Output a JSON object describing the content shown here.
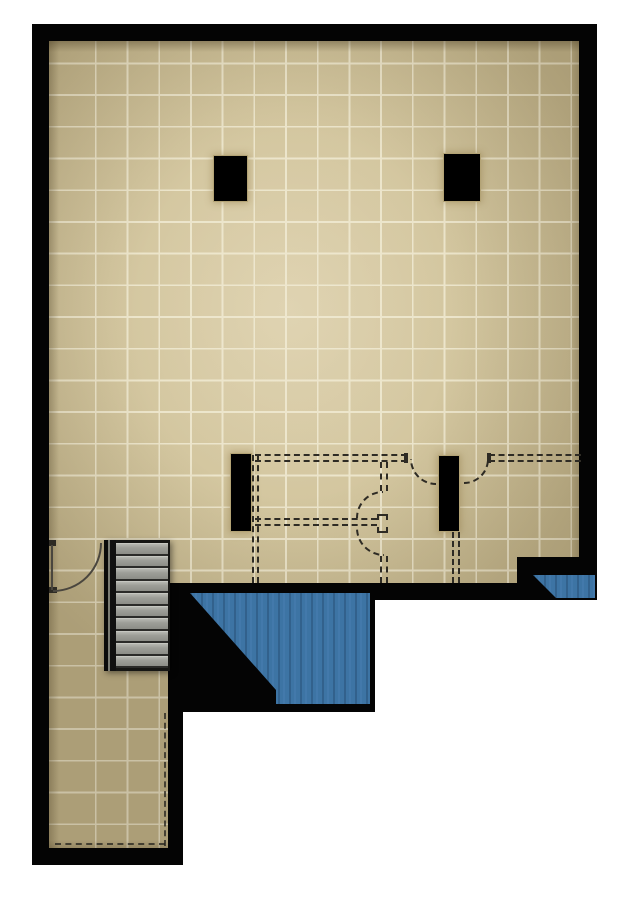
{
  "meta": {
    "type": "architectural-floor-plan-render",
    "canvas_width": 630,
    "canvas_height": 900
  },
  "palette": {
    "wall": "#040404",
    "floor": "#d3c69f",
    "floor_light": "#dccfab",
    "floor_dark": "#c5b890",
    "grid_line": "#ece5cb",
    "column_outline": "#b3a375",
    "stair_frame": "#161614",
    "stair_tread_edge": "#2b2b29",
    "water_base": "#3d74a4",
    "water_dark": "#32618c",
    "water_light": "#4379ab",
    "dashed_line": "#2e2b24",
    "door_arc": "#4a463e"
  },
  "grid": {
    "tile_size": 31.7,
    "offset_x": 16,
    "offset_y": 7
  },
  "floor": {
    "polygon": [
      [
        49,
        41
      ],
      [
        579,
        41
      ],
      [
        579,
        557
      ],
      [
        517,
        557
      ],
      [
        517,
        583
      ],
      [
        168,
        583
      ],
      [
        168,
        848
      ],
      [
        49,
        848
      ]
    ]
  },
  "walls": [
    {
      "name": "wall-top",
      "x": 32,
      "y": 24,
      "w": 565,
      "h": 17
    },
    {
      "name": "wall-left",
      "x": 32,
      "y": 24,
      "w": 17,
      "h": 841
    },
    {
      "name": "wall-right",
      "x": 579,
      "y": 24,
      "w": 18,
      "h": 576
    },
    {
      "name": "wall-main-bottom",
      "x": 183,
      "y": 583,
      "w": 414,
      "h": 17
    },
    {
      "name": "wall-bottom-notch",
      "x": 517,
      "y": 557,
      "w": 80,
      "h": 26
    },
    {
      "name": "wall-corridor-right",
      "x": 168,
      "y": 582,
      "w": 15,
      "h": 283
    },
    {
      "name": "wall-corridor-bottom",
      "x": 32,
      "y": 848,
      "w": 151,
      "h": 17
    },
    {
      "name": "void-below-floor",
      "x": 183,
      "y": 583,
      "w": 192,
      "h": 129
    }
  ],
  "water": [
    {
      "name": "pool-lower-left",
      "polygon": [
        [
          190,
          593
        ],
        [
          370,
          593
        ],
        [
          370,
          704
        ],
        [
          276,
          704
        ],
        [
          276,
          690
        ]
      ]
    },
    {
      "name": "pool-lower-right",
      "polygon": [
        [
          533,
          575
        ],
        [
          595,
          575
        ],
        [
          595,
          598
        ],
        [
          556,
          598
        ]
      ]
    }
  ],
  "columns": [
    {
      "name": "column-upper-left",
      "x": 213,
      "y": 155,
      "w": 35,
      "h": 47
    },
    {
      "name": "column-upper-right",
      "x": 443,
      "y": 153,
      "w": 38,
      "h": 49
    },
    {
      "name": "column-lower-left",
      "x": 230,
      "y": 453,
      "w": 22,
      "h": 79
    },
    {
      "name": "column-lower-right",
      "x": 438,
      "y": 455,
      "w": 22,
      "h": 77
    }
  ],
  "stairs": {
    "name": "staircase",
    "x": 104,
    "y": 540,
    "w": 66,
    "h": 131,
    "rail_w": 12,
    "tread_count": 10
  },
  "partitions": [
    {
      "name": "dashed-wall-top-left",
      "orient": "h",
      "x": 255,
      "y": 454,
      "w": 152,
      "h": 8
    },
    {
      "name": "dashed-wall-top-right",
      "orient": "h",
      "x": 489,
      "y": 454,
      "w": 92,
      "h": 8
    },
    {
      "name": "dashed-wall-mid",
      "orient": "h",
      "x": 255,
      "y": 518,
      "w": 122,
      "h": 8
    },
    {
      "name": "dashed-wall-left-vert",
      "orient": "v",
      "x": 252,
      "y": 455,
      "w": 7,
      "h": 128
    },
    {
      "name": "dashed-wall-center-upper",
      "orient": "v",
      "x": 380,
      "y": 462,
      "w": 8,
      "h": 29
    },
    {
      "name": "dashed-door-post",
      "orient": "box",
      "x": 377,
      "y": 514,
      "w": 11,
      "h": 19
    },
    {
      "name": "dashed-wall-center-lower",
      "orient": "v",
      "x": 380,
      "y": 556,
      "w": 8,
      "h": 27
    },
    {
      "name": "dashed-wall-right-vert",
      "orient": "v",
      "x": 452,
      "y": 532,
      "w": 8,
      "h": 51
    }
  ],
  "ticks": [
    {
      "name": "door-jamb-tick-left",
      "x": 404,
      "y": 453,
      "w": 4,
      "h": 10
    },
    {
      "name": "door-jamb-tick-right",
      "x": 487,
      "y": 453,
      "w": 4,
      "h": 10
    },
    {
      "name": "stair-door-jamb-top",
      "x": 49,
      "y": 540,
      "w": 7,
      "h": 6
    },
    {
      "name": "stair-door-jamb-bottom",
      "x": 49,
      "y": 587,
      "w": 8,
      "h": 6
    }
  ],
  "doors": [
    {
      "name": "door-swing-stair-entry",
      "cx": 53,
      "cy": 543,
      "r": 49,
      "quadrant": "SE",
      "style": "solid",
      "leaf": {
        "x": 51,
        "y": 545,
        "w": 2,
        "h": 45
      }
    },
    {
      "name": "door-swing-column-left",
      "cx": 436,
      "cy": 459,
      "r": 26,
      "quadrant": "SW",
      "style": "dashed"
    },
    {
      "name": "door-swing-column-right",
      "cx": 464,
      "cy": 459,
      "r": 25,
      "quadrant": "SE",
      "style": "dashed"
    },
    {
      "name": "door-swing-partition-up",
      "cx": 383,
      "cy": 518,
      "r": 27,
      "quadrant": "NW",
      "style": "dashed"
    },
    {
      "name": "door-swing-partition-down",
      "cx": 384,
      "cy": 528,
      "r": 28,
      "quadrant": "SW",
      "style": "dashed"
    }
  ],
  "edge_dashes": [
    {
      "name": "corridor-edge-dashes-right",
      "orient": "v",
      "x": 164,
      "y": 713,
      "len": 133
    },
    {
      "name": "corridor-edge-dashes-bottom",
      "orient": "h",
      "x": 55,
      "y": 843,
      "len": 110
    }
  ]
}
